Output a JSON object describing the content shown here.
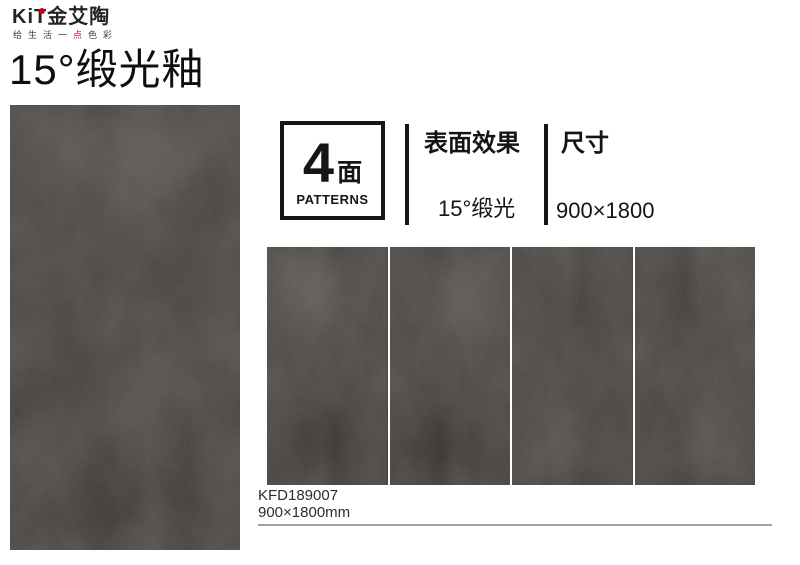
{
  "page": {
    "title": "15°缎光釉"
  },
  "brand": {
    "logo": "KiT金艾陶",
    "tagline": {
      "left": "给生活一",
      "accent": "点",
      "right": "色彩"
    },
    "accent_color": "#d6001c"
  },
  "patterns_box": {
    "count": "4",
    "unit": "面",
    "label": "PATTERNS"
  },
  "specs": [
    {
      "title": "表面效果",
      "value": "15°缎光"
    },
    {
      "title": "尺寸",
      "value": "900×1800"
    }
  ],
  "product": {
    "code": "KFD189007",
    "size": "900×1800mm"
  },
  "tiles": {
    "strip_count": 4,
    "base_color": "#3e3b38"
  },
  "colors": {
    "text": "#1a1a1a",
    "rule": "#a0a0a0"
  }
}
